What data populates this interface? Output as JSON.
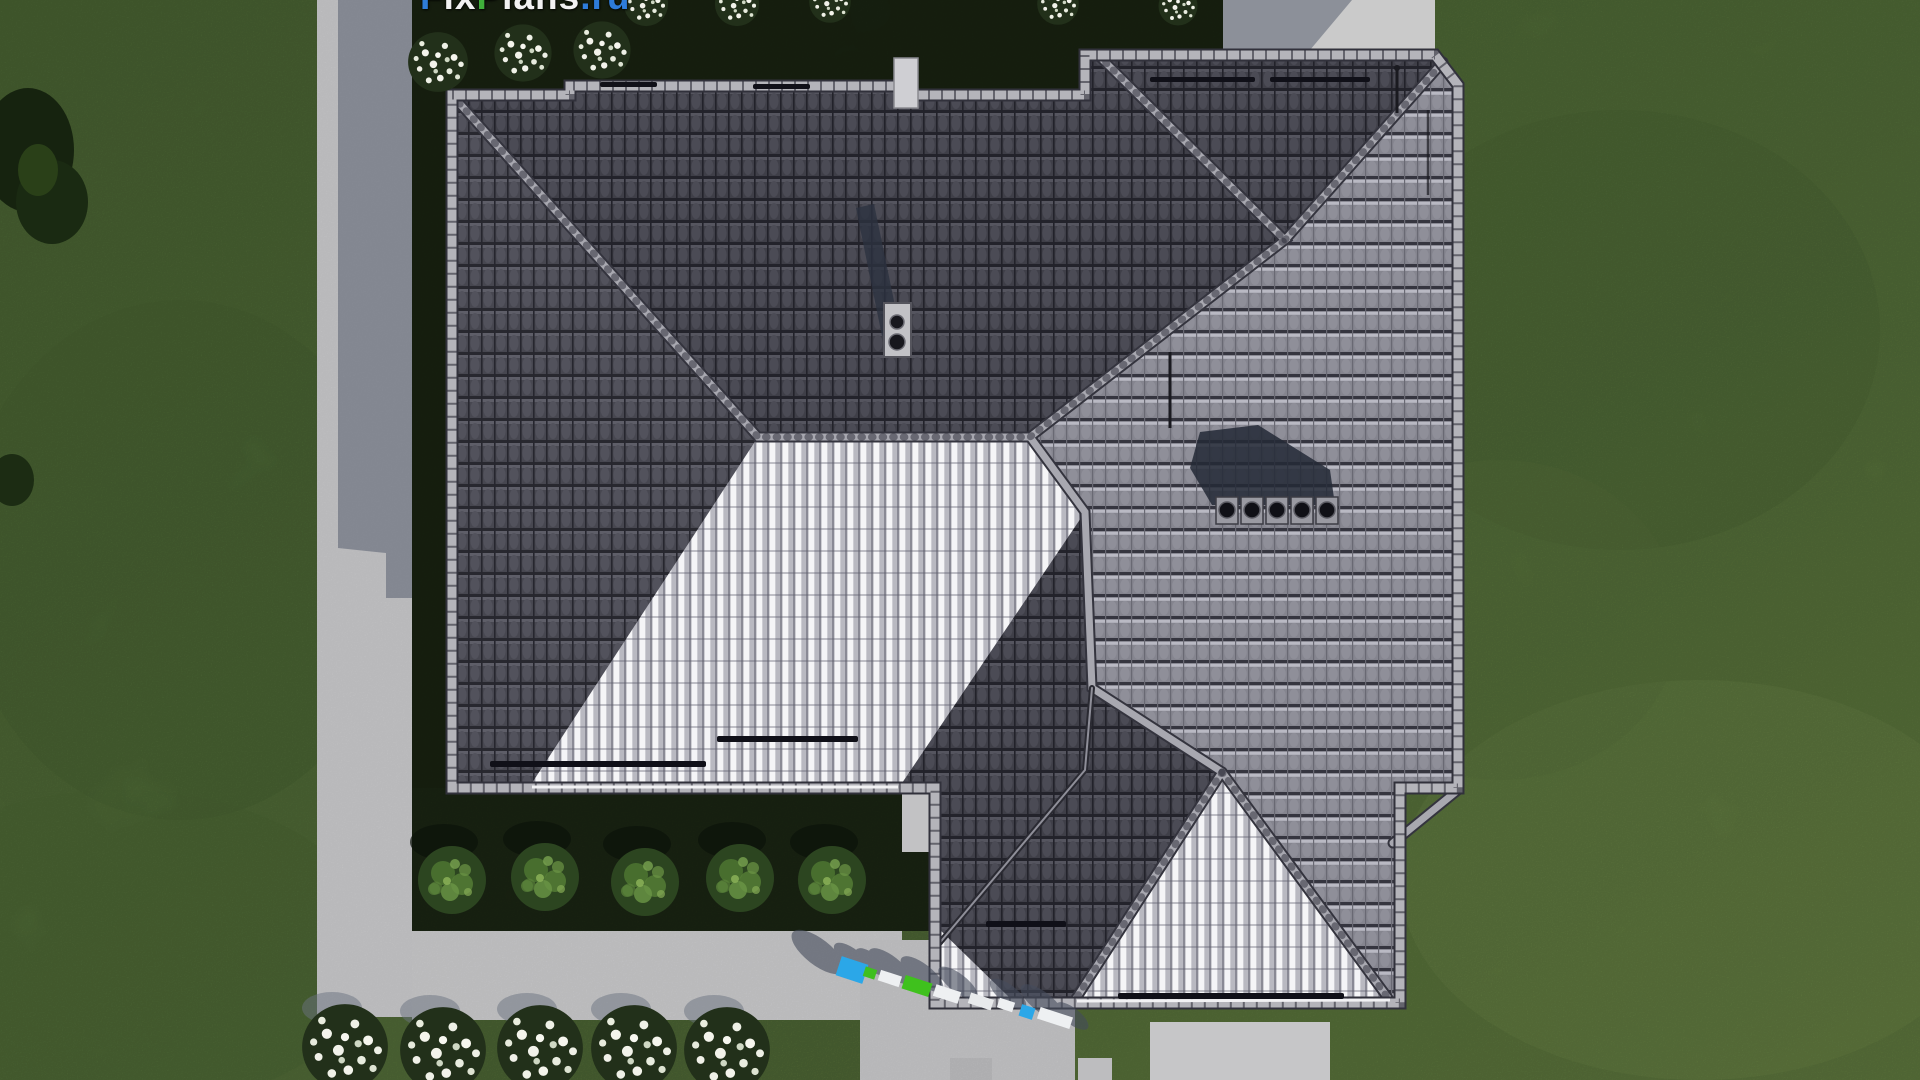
{
  "watermark": {
    "segments": [
      {
        "text": "F",
        "color": "#2e7cd9"
      },
      {
        "text": "ix",
        "color": "#f2f2f2"
      },
      {
        "text": "P",
        "color": "#3fae3a"
      },
      {
        "text": "lans",
        "color": "#f2f2f2"
      },
      {
        "text": ".ru",
        "color": "#2e7cd9"
      }
    ]
  },
  "scene": {
    "description": "Aerial top-down 3D render of a house with a gray hip tile roof, lawn, concrete walkways, hedges and flower beds",
    "palette": {
      "grass": "#5d7c40",
      "shaded_garden": "#1d2915",
      "concrete": "#c8c8ca",
      "roof_dark_slope": "#41414a",
      "roof_medium_slope": "#8a8a94",
      "roof_sunlit_slope": "#eeeef0",
      "ridge_cap": "#a8a8b0",
      "accent_blue_object": "#2ba7e8",
      "accent_green_object": "#3fc11d"
    },
    "counts": {
      "green_hedge_bushes": 5,
      "white_flower_clusters_bottom": 5,
      "white_flower_clusters_top": 6,
      "roof_vents": 5,
      "chimneys": 1
    }
  }
}
